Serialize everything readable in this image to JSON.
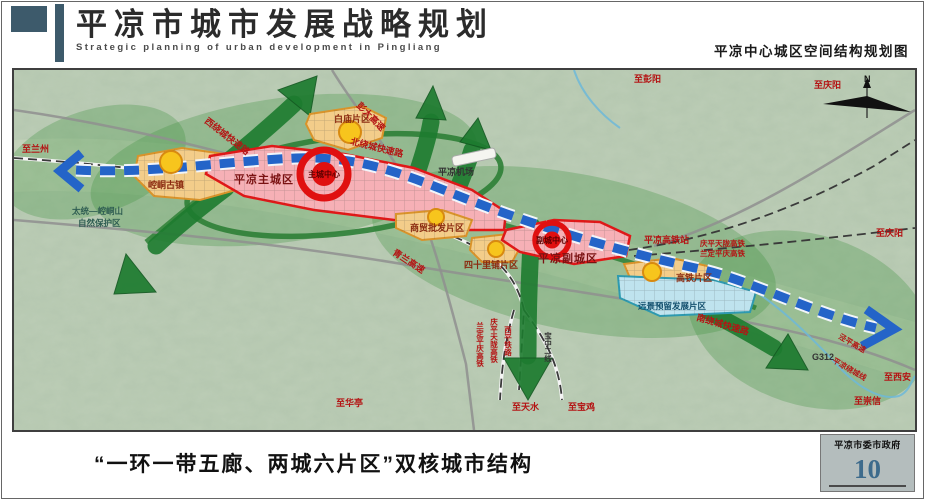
{
  "header": {
    "title": "平凉市城市发展战略规划",
    "subtitle_en": "Strategic planning of urban development in Pingliang",
    "map_title": "平凉中心城区空间结构规划图"
  },
  "map": {
    "north": "N",
    "labels": [
      {
        "text": "至兰州"
      },
      {
        "text": "至彭阳"
      },
      {
        "text": "至庆阳"
      },
      {
        "text": "至庆阳"
      },
      {
        "text": "至西安"
      },
      {
        "text": "至崇信"
      },
      {
        "text": "至华亭"
      },
      {
        "text": "至天水"
      },
      {
        "text": "至宝鸡"
      },
      {
        "text": "太统—崆峒山"
      },
      {
        "text": "自然保护区"
      },
      {
        "text": "崆峒古镇"
      },
      {
        "text": "平凉主城区"
      },
      {
        "text": "主城中心"
      },
      {
        "text": "副城中心"
      },
      {
        "text": "平凉副城区"
      },
      {
        "text": "白庙片区"
      },
      {
        "text": "商贸批发片区"
      },
      {
        "text": "四十里铺片区"
      },
      {
        "text": "高铁片区"
      },
      {
        "text": "远景预留发展片区"
      },
      {
        "text": "平凉高铁站"
      },
      {
        "text": "平凉机场"
      },
      {
        "text": "西绕城快速路"
      },
      {
        "text": "北绕城快速路"
      },
      {
        "text": "南绕城快速路"
      },
      {
        "text": "彭大高速"
      },
      {
        "text": "青兰高速"
      },
      {
        "text": "庆平天陇高铁"
      },
      {
        "text": "兰定平庆高铁"
      },
      {
        "text": "兰定平庆高铁"
      },
      {
        "text": "庆平天陇高铁"
      },
      {
        "text": "西平铁路"
      },
      {
        "text": "宝中二线"
      },
      {
        "text": "G312"
      },
      {
        "text": "泾平高速"
      },
      {
        "text": "平凉绕城线"
      }
    ]
  },
  "footer": {
    "caption": "“一环一带五廊、两城六片区”双核城市结构",
    "agency": "平凉市委市政府",
    "page_number": "10"
  },
  "colors": {
    "deco": "#3d5a6b",
    "red_zone_border": "#e01818",
    "orange_zone_border": "#d9932a",
    "blue_zone_border": "#2e9ab0",
    "belt_blue": "#2464c8",
    "corridor_green": "#1d7b2f",
    "page_number_color": "#3d6b8c"
  }
}
